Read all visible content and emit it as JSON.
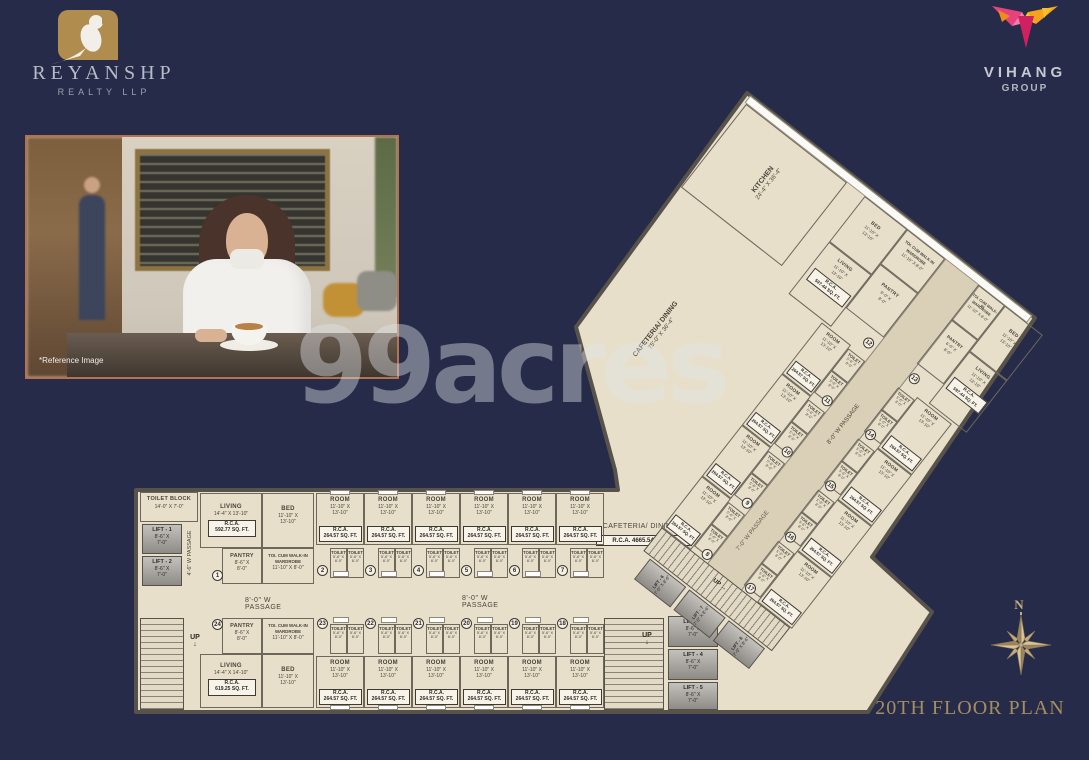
{
  "colors": {
    "background": "#252b48",
    "plan_fill": "#e7dfc9",
    "wall": "#57524a",
    "gold": "#b08c4e",
    "logo_silver": "#b6bcc8",
    "title_gold": "#a58c62",
    "photo_border": "#b5724f",
    "vihang_magenta": "#d6336c",
    "vihang_orange": "#f08c1e",
    "vihang_yellow": "#f6c026"
  },
  "header": {
    "reyanshp_name": "REYANSHP",
    "reyanshp_sub": "REALTY LLP",
    "vihang_name": "VIHANG",
    "vihang_sub": "GROUP"
  },
  "photo": {
    "caption": "*Reference Image"
  },
  "watermark_text": "99acres",
  "title": "20TH FLOOR PLAN",
  "compass_north": "N",
  "plan": {
    "kitchen_name": "KITCHEN",
    "kitchen_dims": "24'-4\" X 36'-4\"",
    "hall_name": "CAFETERIA/ DINING",
    "hall_dims": "75'-0\" X 36'-4\"",
    "cafeteria_name": "CAFETERIA/ DINING",
    "cafeteria_rca": "R.C.A. 4665.54 SQ. FT.",
    "toilet_block_name": "TOILET BLOCK",
    "toilet_block_dims": "14'-0\" X 7'-0\"",
    "passage_46": "4'-6\" W PASSAGE",
    "passage_80_left": "8'-0\" W PASSAGE",
    "passage_80_right": "8'-0\" W PASSAGE",
    "passage_80_wing": "8'-0\" W PASSAGE",
    "passage_70": "7'-0\" W PASSAGE",
    "lobby": "LOBBY",
    "up": "UP",
    "room_name": "ROOM",
    "room_dims1": "11'-10\" X",
    "room_dims2": "13'-10\"",
    "room_rca1": "R.C.A.",
    "room_rca2": "264.57 SQ. FT.",
    "toilet_name": "TOILET",
    "toilet_dims1": "5'-6\" X",
    "toilet_dims2": "8'-0\"",
    "lifts_main": [
      {
        "name": "LIFT - 1",
        "dims1": "8'-6\" X",
        "dims2": "7'-0\""
      },
      {
        "name": "LIFT - 2",
        "dims1": "8'-6\" X",
        "dims2": "7'-0\""
      },
      {
        "name": "LIFT - 3",
        "dims1": "8'-6\" X",
        "dims2": "7'-0\""
      },
      {
        "name": "LIFT - 4",
        "dims1": "8'-6\" X",
        "dims2": "7'-0\""
      },
      {
        "name": "LIFT - 5",
        "dims1": "8'-6\" X",
        "dims2": "7'-0\""
      }
    ],
    "lifts_wing": [
      {
        "name": "LIFT - 6",
        "dims": "7'-0\" X 8'-6\""
      },
      {
        "name": "LIFT - 7",
        "dims": "7'-0\" X 8'-6\""
      },
      {
        "name": "LIFT - 8",
        "dims": "7'-0\" X 8'-6\""
      }
    ],
    "units_top": [
      "2",
      "3",
      "4",
      "5",
      "6",
      "7"
    ],
    "units_bottom": [
      "23",
      "22",
      "21",
      "20",
      "19",
      "18"
    ],
    "units_wing_left": [
      "11",
      "10",
      "9",
      "8"
    ],
    "units_wing_right": [
      "14",
      "15",
      "16",
      "17"
    ],
    "unit_1": {
      "number": "1",
      "living_name": "LIVING",
      "living_dims": "14'-4\" X 13'-10\"",
      "rca1": "R.C.A.",
      "rca2": "592.77 SQ. FT.",
      "bed_name": "BED",
      "bed_dims1": "11'-10\" X",
      "bed_dims2": "13'-10\"",
      "pantry_name": "PANTRY",
      "pantry_dims1": "8'-6\" X",
      "pantry_dims2": "8'-0\"",
      "wardrobe_line1": "TOI. CUM WALK-IN",
      "wardrobe_line2": "WARDROBE",
      "wardrobe_dims": "11'-10\" X 8'-0\""
    },
    "unit_24": {
      "number": "24",
      "living_name": "LIVING",
      "living_dims": "14'-4\" X 14'-10\"",
      "rca1": "R.C.A.",
      "rca2": "619.25 SQ. FT.",
      "bed_name": "BED",
      "bed_dims1": "11'-10\" X",
      "bed_dims2": "13'-10\"",
      "pantry_name": "PANTRY",
      "pantry_dims1": "8'-6\" X",
      "pantry_dims2": "8'-0\"",
      "wardrobe_line1": "TOI. CUM WALK-IN",
      "wardrobe_line2": "WARDROBE",
      "wardrobe_dims": "11'-10\" X 8'-0\""
    },
    "unit_12": {
      "number": "12",
      "bed_name": "BED",
      "bed_dims1": "11'-10\" X",
      "bed_dims2": "13'-10\"",
      "living_name": "LIVING",
      "living_dims1": "11'-10\" X",
      "living_dims2": "13'-10\"",
      "rca1": "R.C.A.",
      "rca2": "597.44 SQ. FT.",
      "pantry_name": "PANTRY",
      "pantry_dims1": "6'-0\" X",
      "pantry_dims2": "8'-0\"",
      "wardrobe_line1": "TOI. CUM WALK-IN",
      "wardrobe_line2": "WARDROBE",
      "wardrobe_dims": "11'-10\" X 8'-0\""
    },
    "unit_13": {
      "number": "13",
      "bed_name": "BED",
      "bed_dims1": "11'-10\" X",
      "bed_dims2": "13'-10\"",
      "living_name": "LIVING",
      "living_dims1": "11'-10\" X",
      "living_dims2": "13'-10\"",
      "rca1": "R.C.A.",
      "rca2": "597.44 SQ. FT.",
      "pantry_name": "PANTRY",
      "pantry_dims1": "6'-0\" X",
      "pantry_dims2": "8'-0\"",
      "wardrobe_line1": "TOI. CUM WALK-IN",
      "wardrobe_line2": "WARDROBE",
      "wardrobe_dims": "11'-10\" X 8'-0\""
    }
  }
}
